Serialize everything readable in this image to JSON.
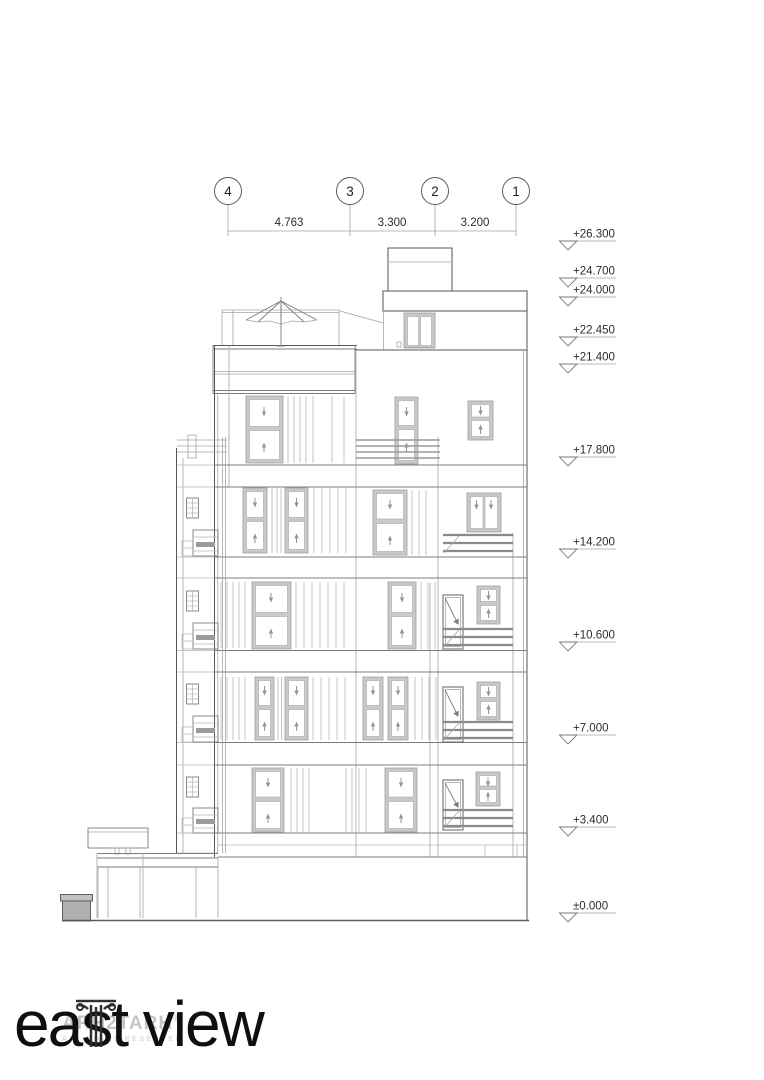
{
  "grid": {
    "bubbles": [
      "4",
      "3",
      "2",
      "1"
    ],
    "dims": [
      "4.763",
      "3.300",
      "3.200"
    ]
  },
  "levels": [
    {
      "label": "+26.300"
    },
    {
      "label": "+24.700"
    },
    {
      "label": "+24.000"
    },
    {
      "label": "+22.450"
    },
    {
      "label": "+21.400"
    },
    {
      "label": "+17.800"
    },
    {
      "label": "+14.200"
    },
    {
      "label": "+10.600"
    },
    {
      "label": "+7.000"
    },
    {
      "label": "+3.400"
    },
    {
      "label": "±0.000"
    }
  ],
  "title": {
    "text": "east view"
  },
  "watermark": {
    "brand": "ARH2TARH",
    "registered": "®",
    "rights": "ALL RIGHT RESERVED"
  }
}
